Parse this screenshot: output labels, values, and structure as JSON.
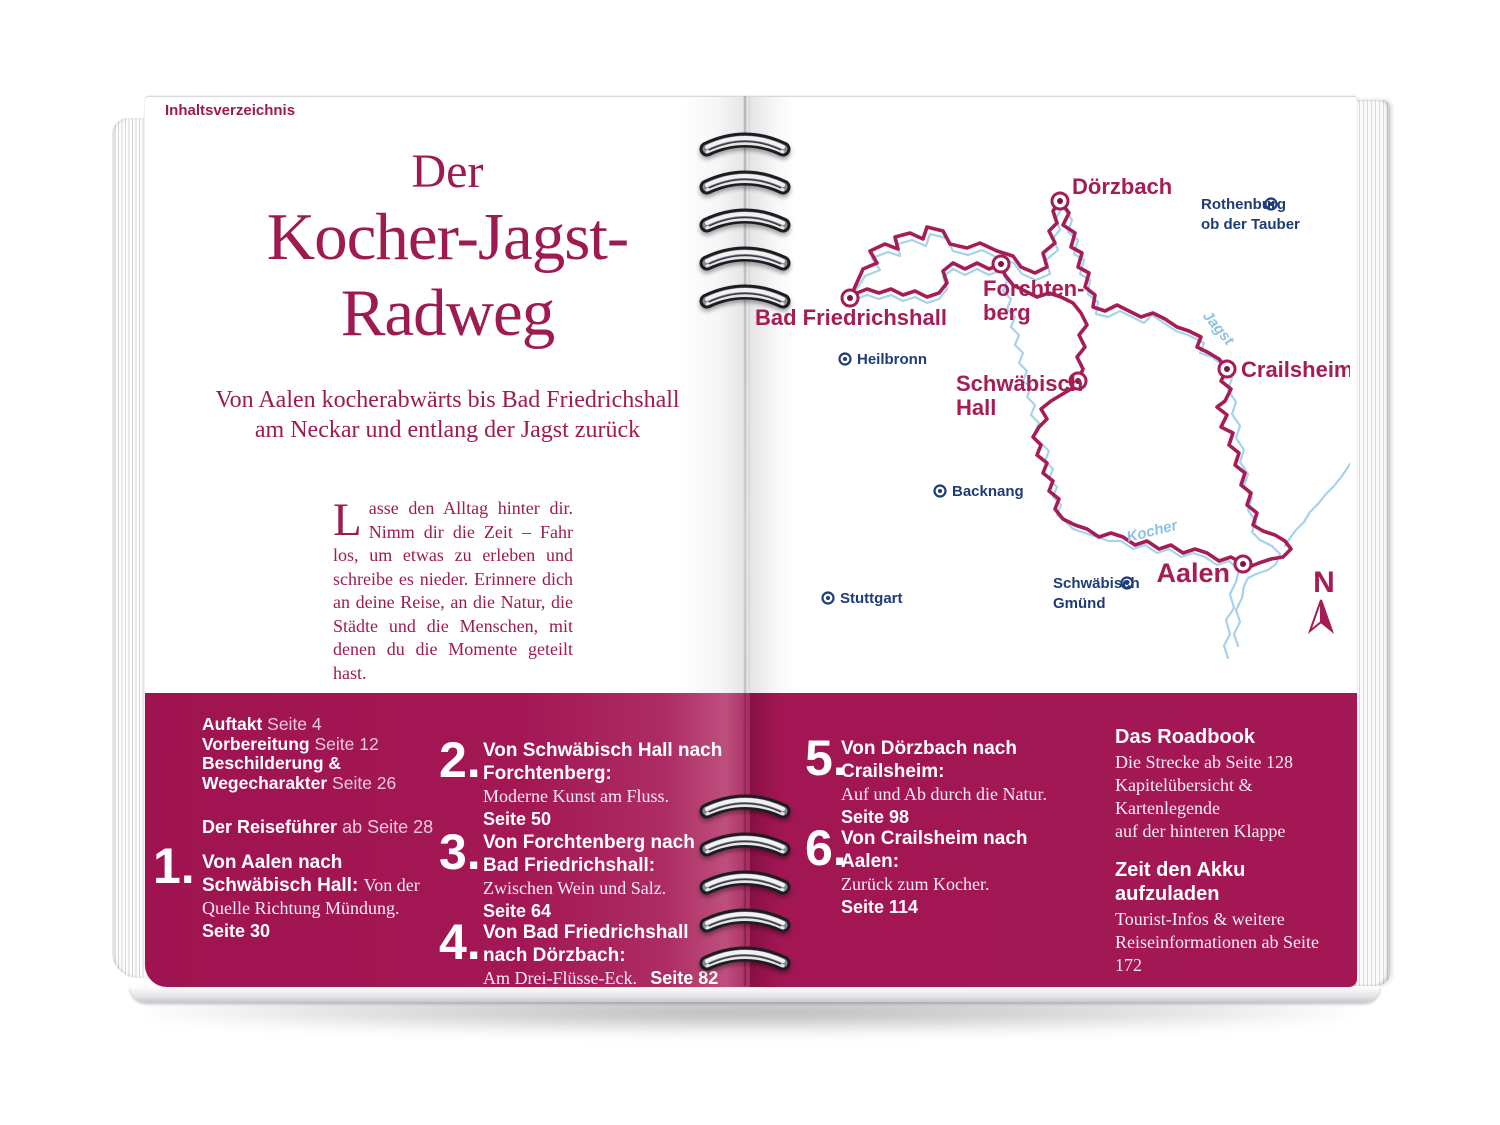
{
  "page": {
    "header_label": "Inhaltsverzeichnis"
  },
  "title": {
    "line1": "Der",
    "line2": "Kocher-Jagst-",
    "line3": "Radweg"
  },
  "subtitle": {
    "line1": "Von Aalen kocherabwärts bis Bad Friedrichshall",
    "line2": "am Neckar und entlang der Jagst zurück"
  },
  "intro": {
    "dropcap": "L",
    "rest": "asse den Alltag hinter dir. Nimm dir die Zeit – Fahr los, um etwas zu erleben und schreibe es nieder. Erinnere dich an deine Reise, an die Natur, die Städte und die Menschen, mit denen du die Momente geteilt hast."
  },
  "map": {
    "stage_cities": {
      "bad_friedrichshall": "Bad Friedrichshall",
      "doerzbach": "Dörzbach",
      "forchtenberg_l1": "Forchten-",
      "forchtenberg_l2": "berg",
      "schwaebisch_hall_l1": "Schwäbisch",
      "schwaebisch_hall_l2": "Hall",
      "crailsheim": "Crailsheim",
      "aalen": "Aalen"
    },
    "reference_cities": {
      "rothenburg_l1": "Rothenburg",
      "rothenburg_l2": "ob der Tauber",
      "heilbronn": "Heilbronn",
      "backnang": "Backnang",
      "stuttgart": "Stuttgart",
      "schwaebisch_gmuend_l1": "Schwäbisch",
      "schwaebisch_gmuend_l2": "Gmünd"
    },
    "rivers": {
      "jagst": "Jagst",
      "kocher": "Kocher"
    },
    "compass_label": "N",
    "colors": {
      "route": "#a51d55",
      "river": "#a6d2ee",
      "stage_label": "#a51d55",
      "reference_label": "#1e3c78",
      "band": "#a21753",
      "headline": "#9e1b51"
    }
  },
  "toc": {
    "general": [
      {
        "label": "Auftakt",
        "page": "Seite 4"
      },
      {
        "label": "Vorbereitung",
        "page": "Seite 12"
      },
      {
        "label": "Beschilderung &",
        "page": ""
      },
      {
        "label": "Wegecharakter",
        "page": "Seite 26"
      }
    ],
    "guide": {
      "label": "Der Reiseführer",
      "page": "ab Seite 28"
    },
    "stages": [
      {
        "num": "1.",
        "title": "Von Aalen nach Schwäbisch Hall:",
        "desc": "Von der Quelle Richtung Mündung.",
        "page": "Seite 30"
      },
      {
        "num": "2.",
        "title": "Von Schwäbisch Hall nach Forchtenberg:",
        "desc": "Moderne Kunst am Fluss.",
        "page": "Seite 50"
      },
      {
        "num": "3.",
        "title": "Von Forchtenberg nach Bad Friedrichshall:",
        "desc": "Zwischen Wein und Salz.",
        "page": "Seite 64"
      },
      {
        "num": "4.",
        "title": "Von Bad Friedrichshall nach Dörzbach:",
        "desc": "Am Drei-Flüsse-Eck.",
        "page": "Seite 82"
      },
      {
        "num": "5.",
        "title": "Von Dörzbach nach Crailsheim:",
        "desc": "Auf und Ab durch die Natur.",
        "page": "Seite 98"
      },
      {
        "num": "6.",
        "title": "Von Crailsheim nach Aalen:",
        "desc": "Zurück zum Kocher.",
        "page": "Seite 114"
      }
    ],
    "extras": [
      {
        "title": "Das Roadbook",
        "line1": "Die Strecke ab Seite 128",
        "line2": "Kapitelübersicht & Kartenlegende",
        "line3": "auf der hinteren Klappe"
      },
      {
        "title": "Zeit den Akku aufzuladen",
        "line1": "Tourist-Infos & weitere",
        "line2": "Reiseinformationen ab Seite 172",
        "line3": ""
      },
      {
        "title": "Die Extra-Tourenkarte",
        "line1": "Landschaften und",
        "line2": "Sehenswürdigkeiten des Radwegs",
        "line3": ""
      }
    ]
  }
}
